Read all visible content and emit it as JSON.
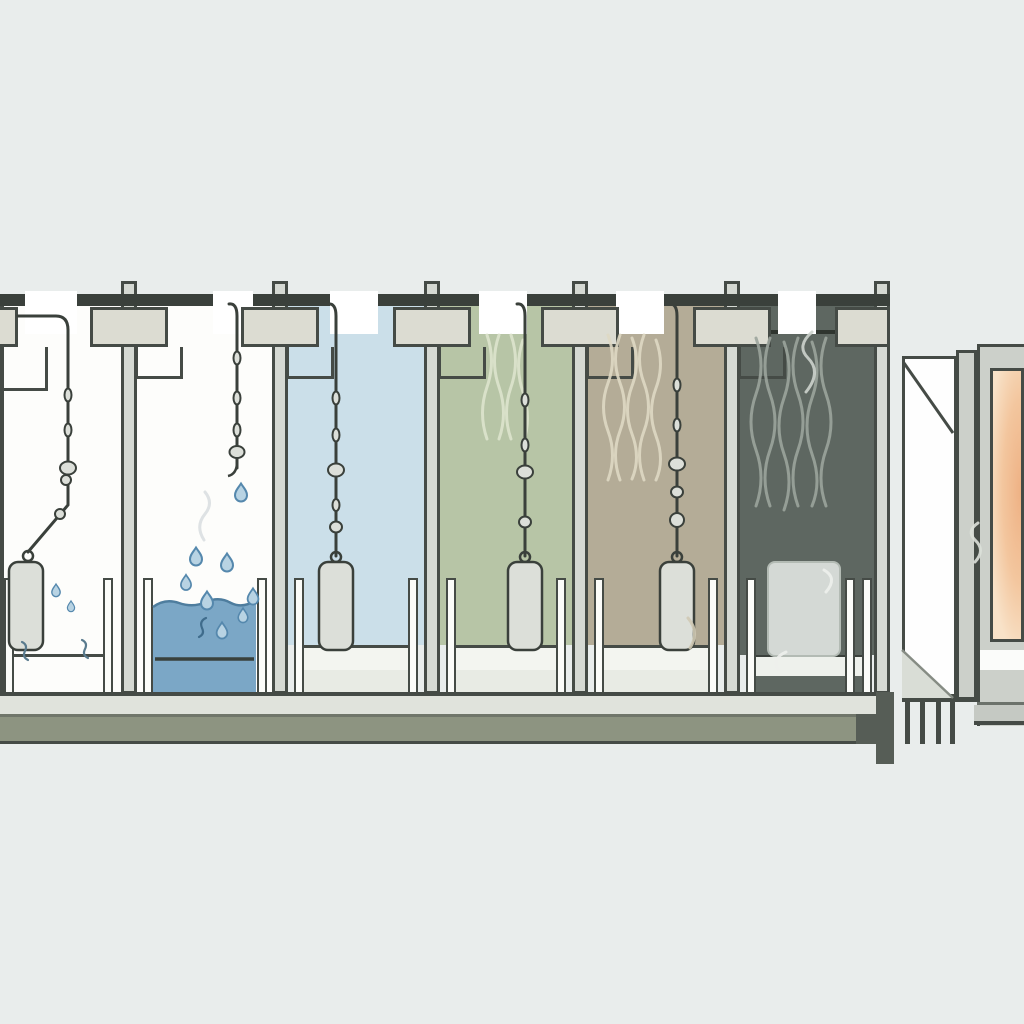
{
  "scene_type": "industrial-dip-line-cross-section-illustration",
  "colors": {
    "background": "#e9edec",
    "outline": "#454b46",
    "rail": "#3a403b",
    "post_fill": "#d5d9d3",
    "plate_fill": "#dcdcd2",
    "tank_wall": "#fbfcf9",
    "tank_rim": "#f3f5f0",
    "tank_front": "#e8ebe4",
    "part_fill": "#dcdfd9",
    "droplet_fill": "#b8d3e3",
    "droplet_edge": "#5588ad",
    "floor_light": "#e0e3dc",
    "floor_olive": "#8d9481",
    "floor_dark_end": "#565d56",
    "oven_frame": "#ccd0ca",
    "oven_glow_center": "#eeb184",
    "oven_glow_mid": "#f3c69e",
    "oven_glow_edge": "#f8e2c8"
  },
  "stations": [
    {
      "id": "station-1",
      "label": "drip-station",
      "wall": "#fdfdfb",
      "load": "suspended-canister-dripping"
    },
    {
      "id": "station-2",
      "label": "dip-tank-station",
      "wall": "#fdfdfb",
      "water": "#7ba7c6",
      "load": "empty-hook-droplets-falling"
    },
    {
      "id": "station-3",
      "label": "rinse-station",
      "wall": "#cbdfe9",
      "load": "suspended-canister"
    },
    {
      "id": "station-4",
      "label": "vapor-station-green",
      "wall": "#b7c5a6",
      "steam": "#dde3cd",
      "load": "suspended-canister"
    },
    {
      "id": "station-5",
      "label": "vapor-station-tan",
      "wall": "#b4ac97",
      "steam": "#ded8c3",
      "load": "suspended-canister"
    },
    {
      "id": "station-6",
      "label": "hot-chamber",
      "wall": "#5e6761",
      "steam": "#9ba49c",
      "load": "floor-bin-steaming"
    },
    {
      "id": "station-7",
      "label": "oven",
      "glow_center": "#eeb184",
      "glow_mid": "#f3c69e",
      "glow_edge": "#f8e2c8"
    }
  ]
}
